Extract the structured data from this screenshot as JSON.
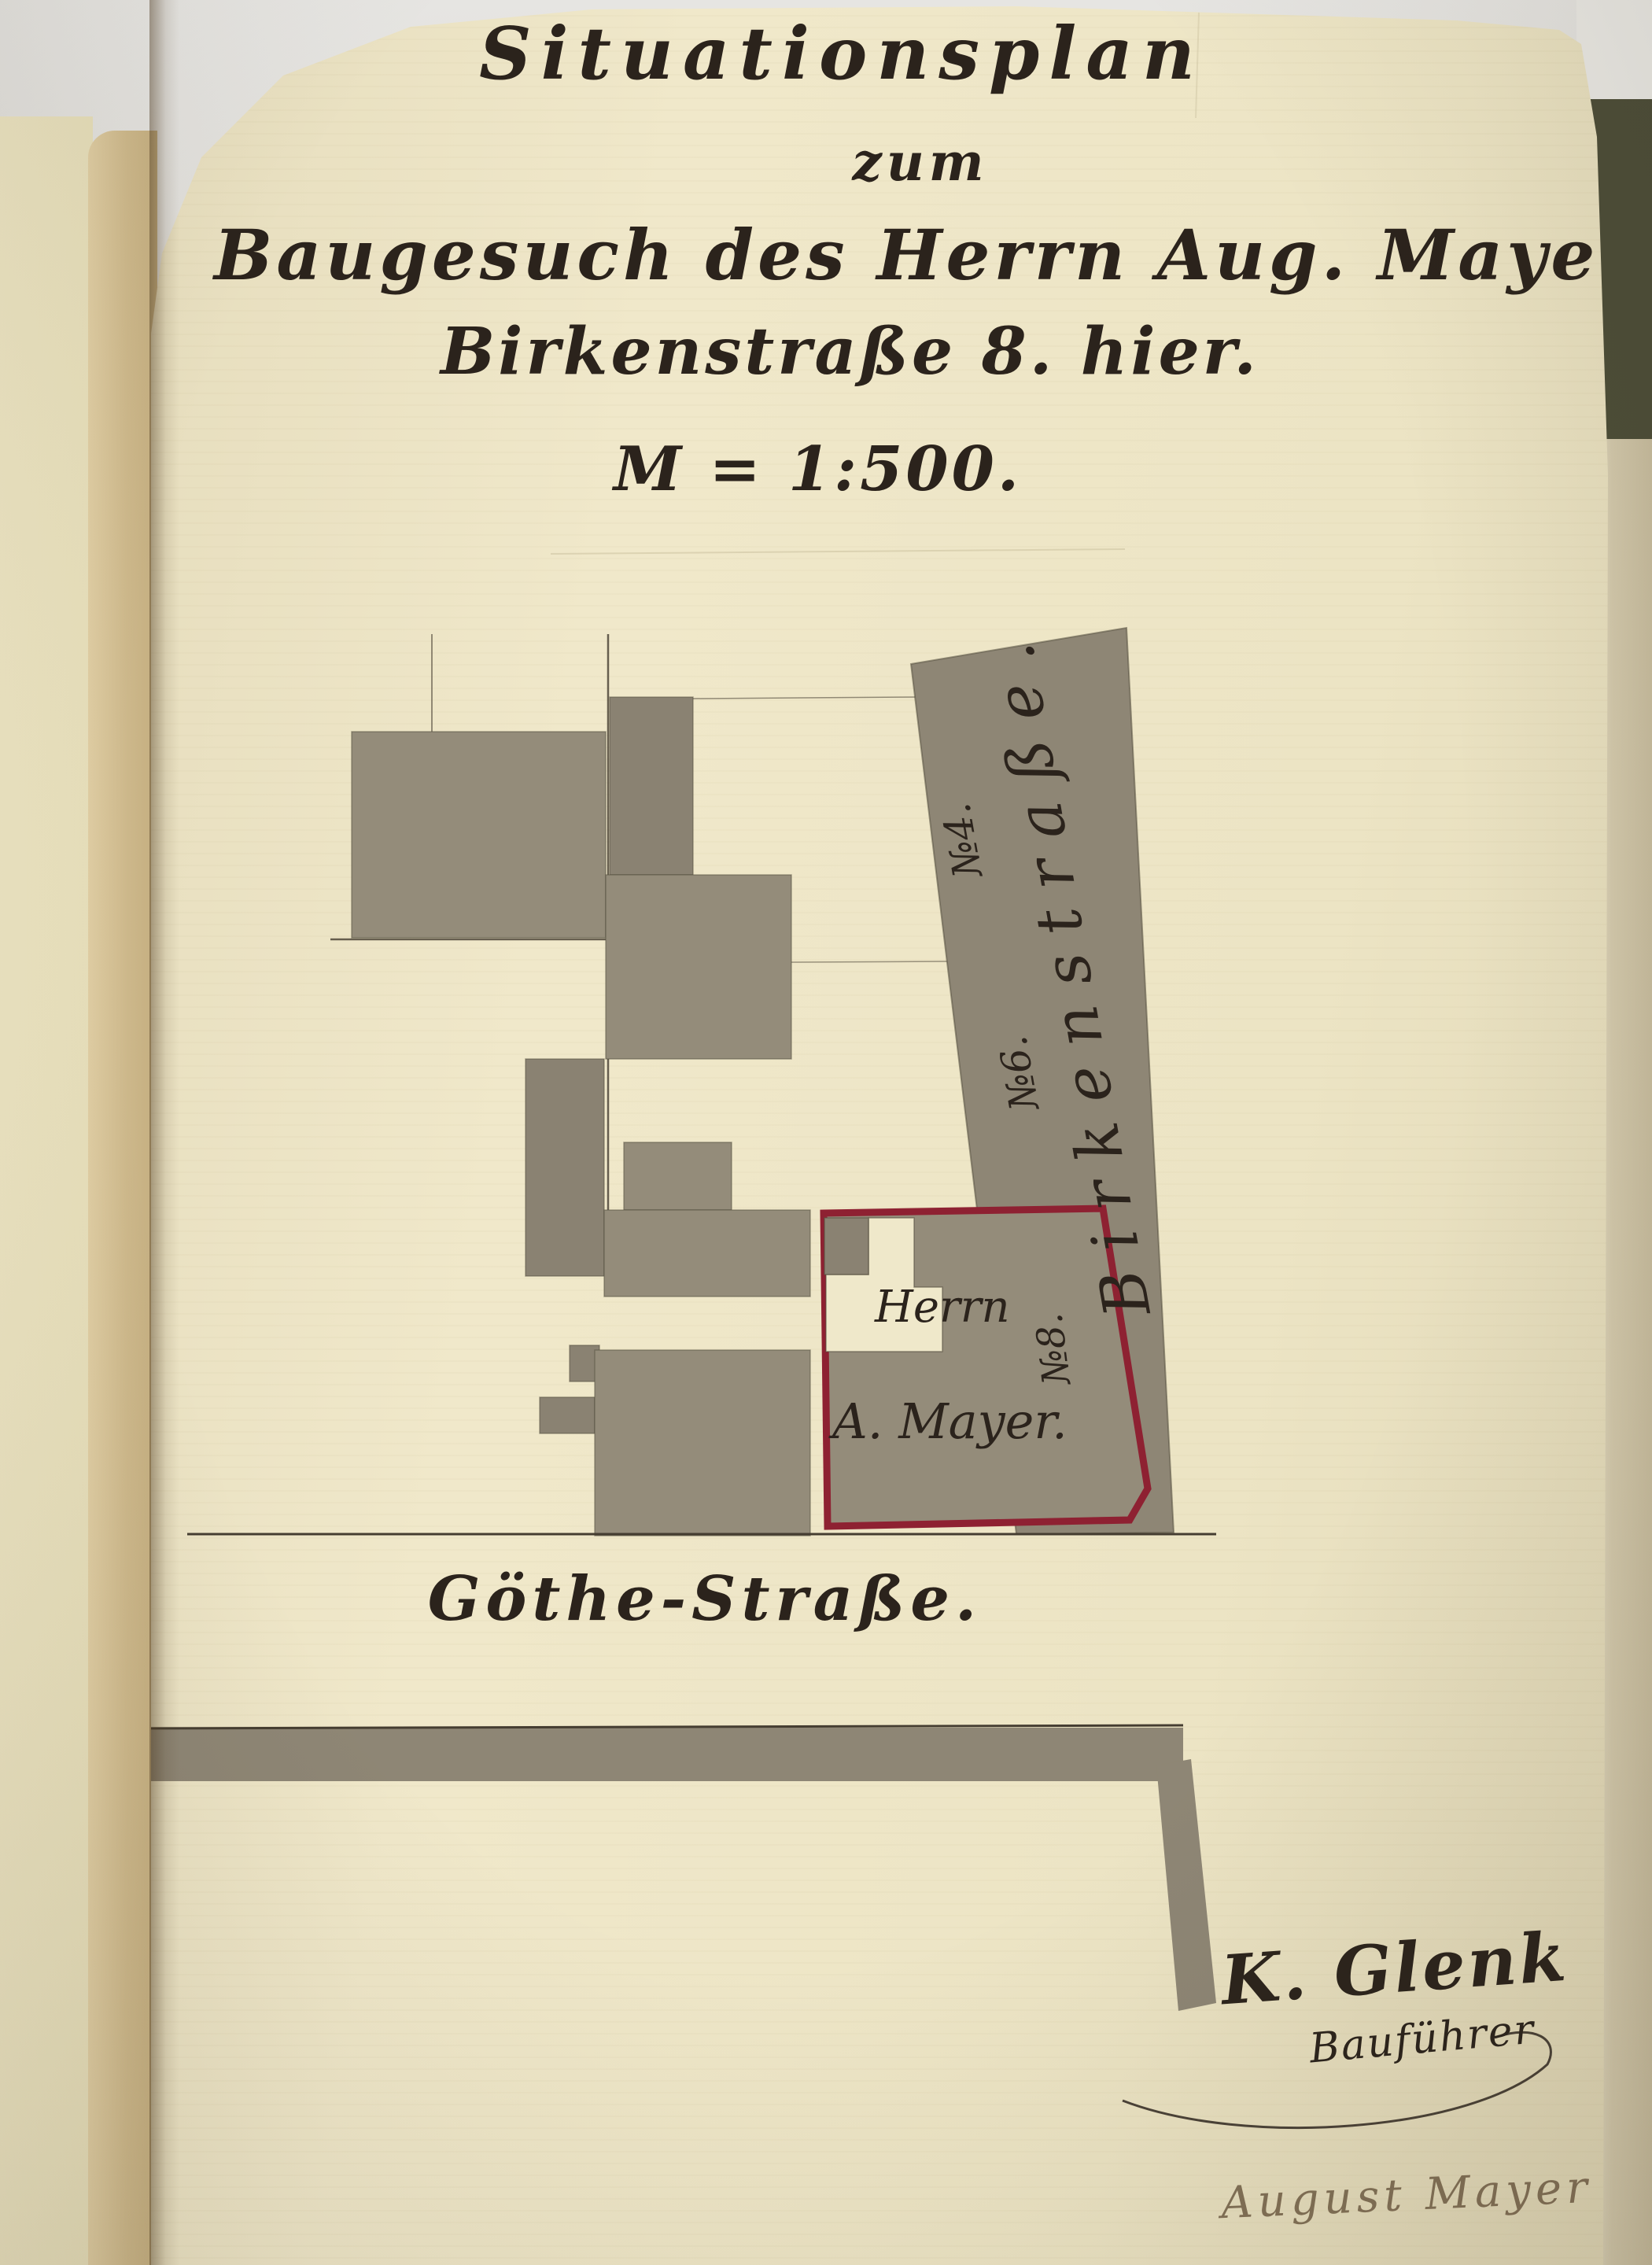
{
  "page": {
    "title": "Situationsplan",
    "subtitle": "zum",
    "line3": "Baugesuch des Herrn Aug. Mayer,",
    "line4": "Birkenstraße 8. hier.",
    "scale": "M = 1:500."
  },
  "plan": {
    "street_side_label": "Birkenstraße.",
    "street_bottom_label": "Göthe-Straße.",
    "house_number_4": "№4.",
    "house_number_6": "№6.",
    "parcel_owner_line1": "Herrn",
    "parcel_owner_line2": "A. Mayer.",
    "parcel_number": "№8."
  },
  "signatures": {
    "architect_name": "K. Glenk",
    "architect_role": "Bauführer",
    "applicant_name": "August Mayer"
  },
  "colors": {
    "paper": "#ede5c5",
    "ink": "#2b231c",
    "wash_grey": "#8e8675",
    "parcel_red": "#8e2132",
    "table_background": "#d8d6d1",
    "book_cover_green": "#4c4d38"
  }
}
